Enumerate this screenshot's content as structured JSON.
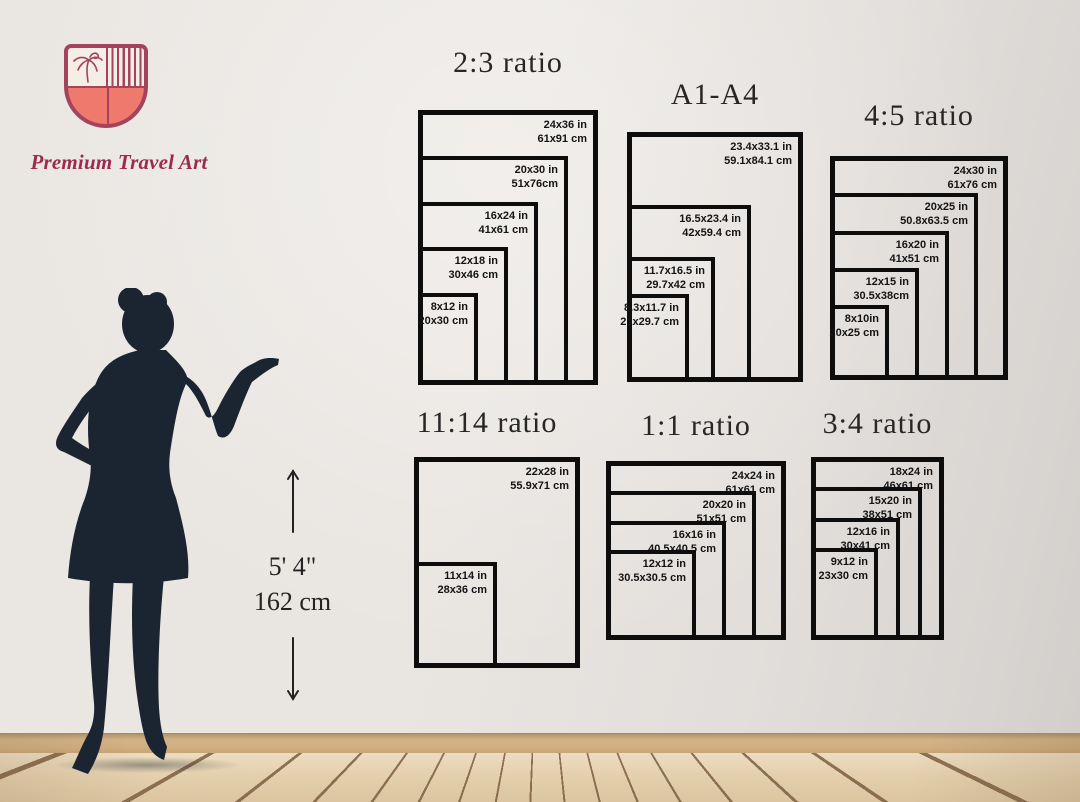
{
  "brand": {
    "name": "Premium Travel Art",
    "logo": {
      "icon": "shield-with-palm-tree-and-stripes",
      "colors": {
        "outline": "#a4435c",
        "fill": "#f0796d",
        "panel": "#f5eee5",
        "text": "#9b2c50"
      }
    }
  },
  "scale_reference": {
    "figure": "woman-silhouette",
    "height_imperial": "5' 4\"",
    "height_metric": "162 cm",
    "silhouette_color": "#1b2531"
  },
  "size_groups": [
    {
      "title": "2:3 ratio",
      "sizes": [
        {
          "inches": "24x36 in",
          "cm": "61x91 cm"
        },
        {
          "inches": "20x30 in",
          "cm": "51x76cm"
        },
        {
          "inches": "16x24 in",
          "cm": "41x61 cm"
        },
        {
          "inches": "12x18 in",
          "cm": "30x46 cm"
        },
        {
          "inches": "8x12 in",
          "cm": "20x30 cm"
        }
      ]
    },
    {
      "title": "A1-A4",
      "sizes": [
        {
          "inches": "23.4x33.1 in",
          "cm": "59.1x84.1 cm"
        },
        {
          "inches": "16.5x23.4 in",
          "cm": "42x59.4 cm"
        },
        {
          "inches": "11.7x16.5 in",
          "cm": "29.7x42 cm"
        },
        {
          "inches": "8.3x11.7 in",
          "cm": "21x29.7 cm"
        }
      ]
    },
    {
      "title": "4:5 ratio",
      "sizes": [
        {
          "inches": "24x30 in",
          "cm": "61x76 cm"
        },
        {
          "inches": "20x25 in",
          "cm": "50.8x63.5 cm"
        },
        {
          "inches": "16x20 in",
          "cm": "41x51 cm"
        },
        {
          "inches": "12x15 in",
          "cm": "30.5x38cm"
        },
        {
          "inches": "8x10in",
          "cm": "20x25 cm"
        }
      ]
    },
    {
      "title": "11:14 ratio",
      "sizes": [
        {
          "inches": "22x28 in",
          "cm": "55.9x71 cm"
        },
        {
          "inches": "11x14 in",
          "cm": "28x36 cm"
        }
      ]
    },
    {
      "title": "1:1 ratio",
      "sizes": [
        {
          "inches": "24x24 in",
          "cm": "61x61 cm"
        },
        {
          "inches": "20x20 in",
          "cm": "51x51 cm"
        },
        {
          "inches": "16x16 in",
          "cm": "40.5x40.5 cm"
        },
        {
          "inches": "12x12 in",
          "cm": "30.5x30.5 cm"
        }
      ]
    },
    {
      "title": "3:4 ratio",
      "sizes": [
        {
          "inches": "18x24 in",
          "cm": "46x61 cm"
        },
        {
          "inches": "15x20 in",
          "cm": "38x51 cm"
        },
        {
          "inches": "12x16 in",
          "cm": "30x41 cm"
        },
        {
          "inches": "9x12 in",
          "cm": "23x30 cm"
        }
      ]
    }
  ],
  "scene": {
    "wall_color": "#e8e5e1",
    "baseboard_color": "#d0ae80",
    "floor_color": "#e4d0ae",
    "frame_border_color": "#0d0d0d"
  }
}
